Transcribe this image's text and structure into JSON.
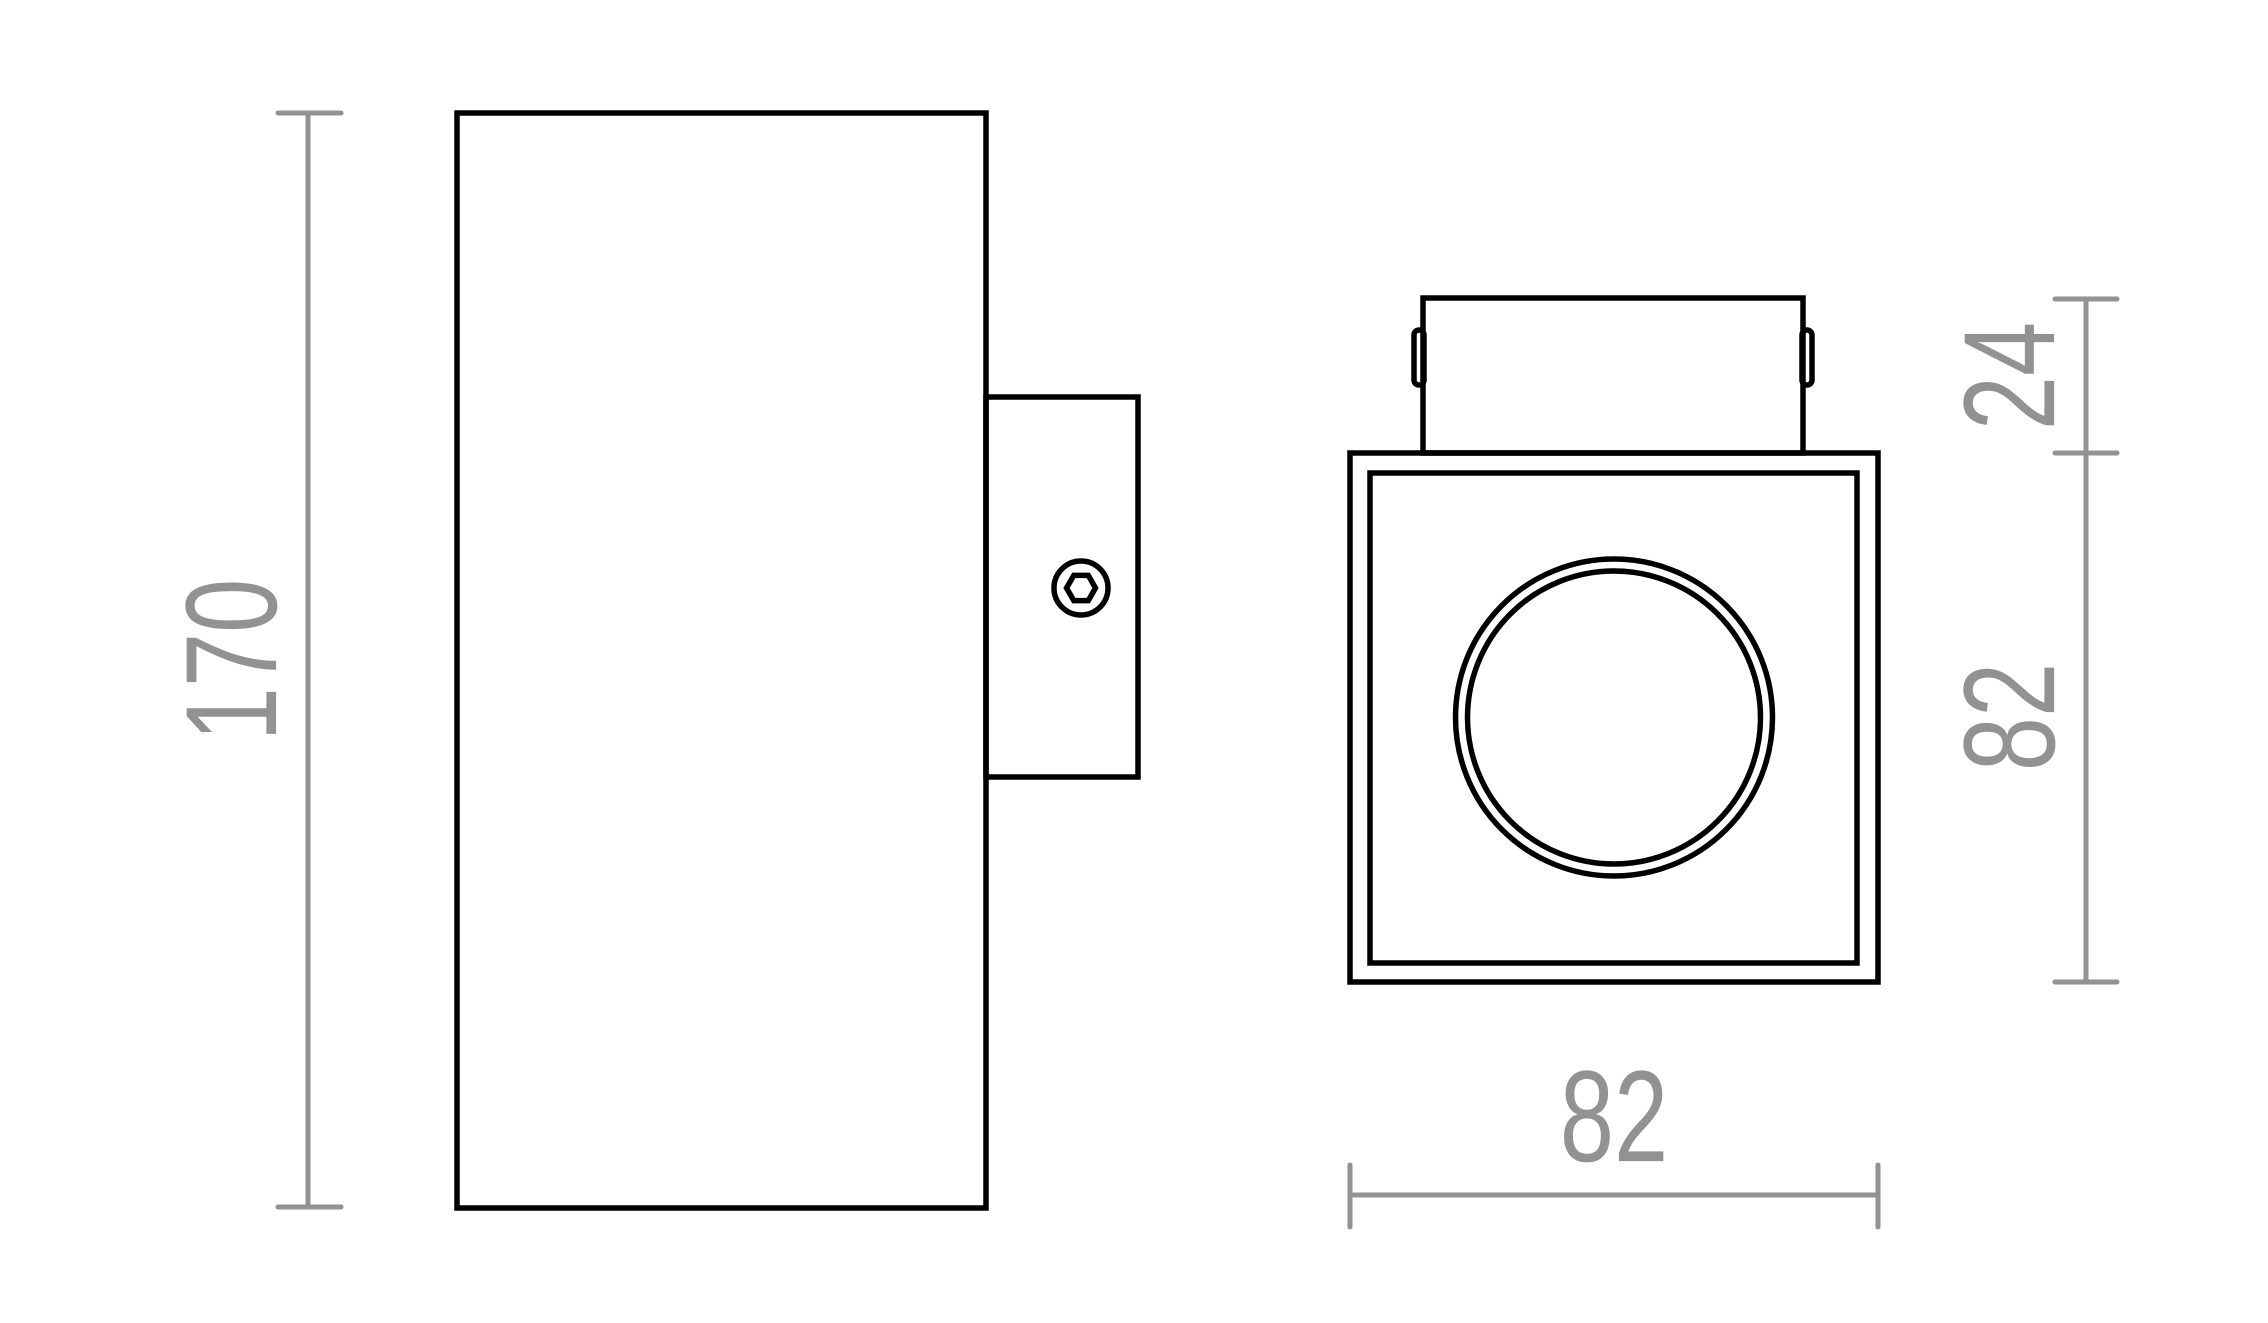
{
  "drawing": {
    "dimensions": {
      "body_height": "170",
      "bracket_depth": "24",
      "face_height": "82",
      "face_width": "82"
    },
    "colors": {
      "outline": "#000000",
      "dimension": "#929292"
    }
  }
}
